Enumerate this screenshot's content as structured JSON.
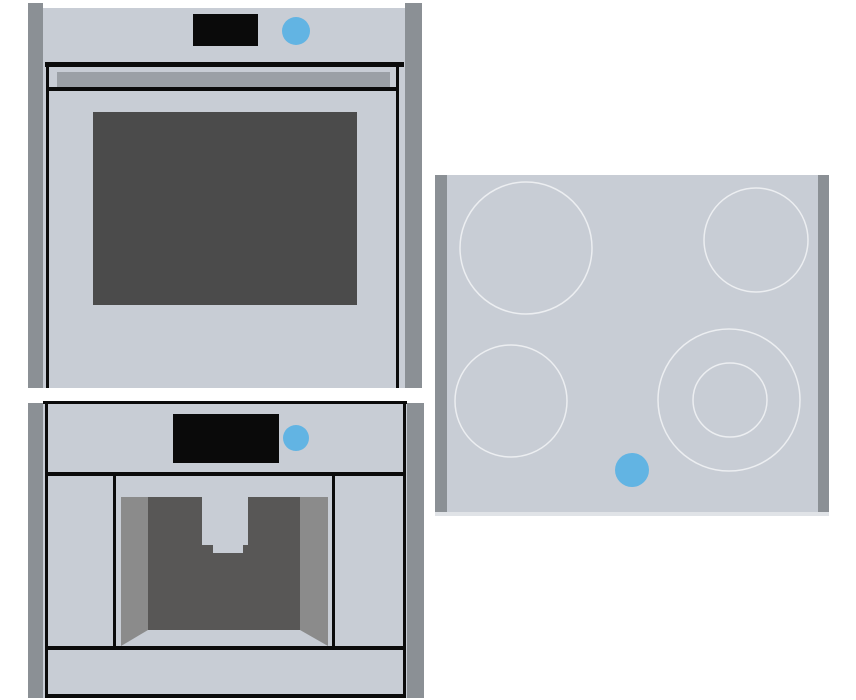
{
  "scene": {
    "appliances": [
      {
        "id": "oven",
        "label": "built-in-oven"
      },
      {
        "id": "coffee-machine",
        "label": "built-in-coffee-machine"
      },
      {
        "id": "cooktop",
        "label": "ceramic-glass-cooktop"
      }
    ]
  },
  "colors": {
    "background": "#ffffff",
    "appliance_body": "#c8cdd5",
    "side_panel": "#8b9095",
    "outline": "#0b0b0b",
    "display": "#0a0a0a",
    "oven_window": "#4b4b4b",
    "oven_handle": "#9ba0a6",
    "niche_wall": "#8b8b8b",
    "niche_back": "#585756",
    "accent_blue": "#62b4e3",
    "burner_ring": "#eceef1",
    "cooktop_edge": "#e0e3e7"
  }
}
